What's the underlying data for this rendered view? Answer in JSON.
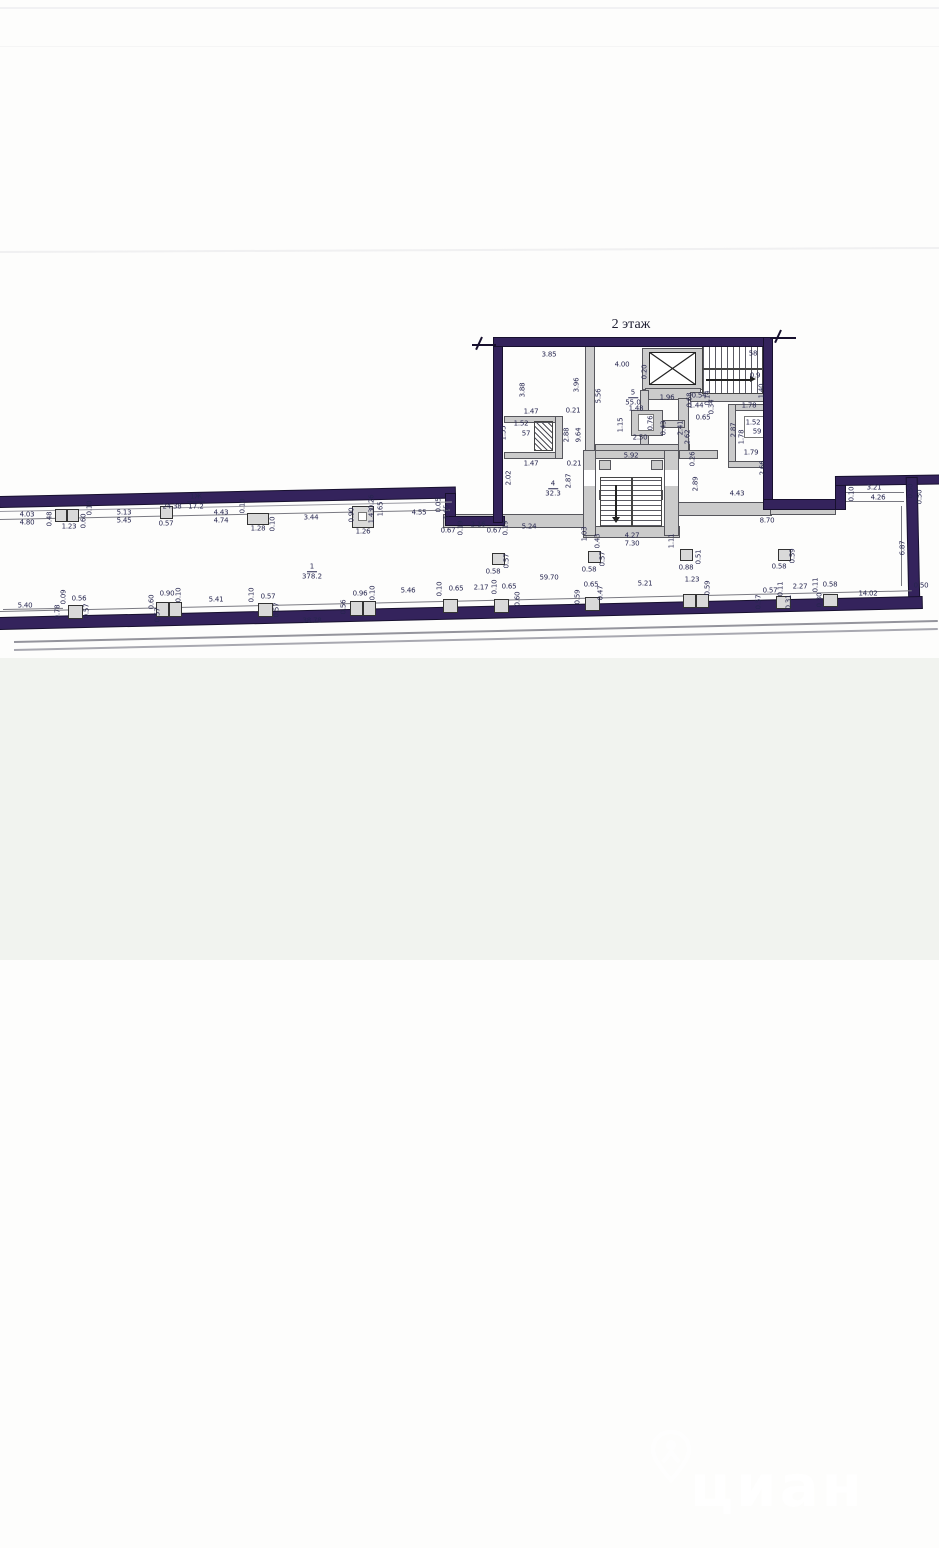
{
  "page": {
    "floor_title": "2 этаж"
  },
  "watermark": {
    "text": "циан"
  },
  "colors": {
    "wall": "#34235c",
    "dim_text": "#26264f",
    "paper": "#fdfdfc",
    "lower_bg": "#f1f3ef"
  },
  "plan": {
    "room_labels": [
      {
        "num": "1",
        "area": "378.2",
        "x": 312,
        "y": 571
      },
      {
        "num": "4",
        "area": "32.3",
        "x": 553,
        "y": 488
      },
      {
        "num": "5",
        "area": "55.0",
        "x": 633,
        "y": 397
      },
      {
        "num": "1Ж",
        "area": "17.2",
        "x": 196,
        "y": 501
      }
    ],
    "dimensions": [
      [
        "4.03",
        27,
        515,
        0
      ],
      [
        "4.80",
        27,
        523,
        0
      ],
      [
        "0.48",
        50,
        519,
        1
      ],
      [
        "1.23",
        69,
        527,
        0
      ],
      [
        "0.60",
        84,
        521,
        1
      ],
      [
        "0.10",
        90,
        508,
        1
      ],
      [
        "5.13",
        124,
        513,
        0
      ],
      [
        "5.45",
        124,
        521,
        0
      ],
      [
        "24.38",
        172,
        507,
        0
      ],
      [
        "0.57",
        166,
        524,
        0
      ],
      [
        "4.43",
        221,
        513,
        0
      ],
      [
        "4.74",
        221,
        521,
        0
      ],
      [
        "0.10",
        243,
        506,
        1
      ],
      [
        "1.28",
        258,
        529,
        0
      ],
      [
        "0.10",
        273,
        524,
        1
      ],
      [
        "3.44",
        311,
        518,
        0
      ],
      [
        "0.90",
        352,
        515,
        1
      ],
      [
        "0.26",
        372,
        502,
        1
      ],
      [
        "1.26",
        363,
        532,
        0
      ],
      [
        "1.43",
        372,
        516,
        1
      ],
      [
        "1.65",
        381,
        509,
        1
      ],
      [
        "4.55",
        419,
        513,
        0
      ],
      [
        "0.05",
        439,
        505,
        1
      ],
      [
        "1.65",
        447,
        512,
        1
      ],
      [
        "0.67",
        448,
        531,
        0
      ],
      [
        "0.19",
        461,
        528,
        1
      ],
      [
        "2.16",
        478,
        525,
        0
      ],
      [
        "0.67",
        494,
        531,
        0
      ],
      [
        "0.19",
        506,
        528,
        1
      ],
      [
        "5.24",
        529,
        527,
        0
      ],
      [
        "1.03",
        585,
        534,
        1
      ],
      [
        "0.43",
        598,
        541,
        1
      ],
      [
        "4.27",
        632,
        536,
        0
      ],
      [
        "7.30",
        632,
        544,
        0
      ],
      [
        "1.11",
        672,
        541,
        1
      ],
      [
        "8.70",
        767,
        521,
        0
      ],
      [
        "4.43",
        737,
        494,
        0
      ],
      [
        "3.85",
        549,
        355,
        0
      ],
      [
        "3.88",
        523,
        390,
        1
      ],
      [
        "3.96",
        577,
        385,
        1
      ],
      [
        "1.47",
        531,
        412,
        0
      ],
      [
        "0.21",
        573,
        411,
        0
      ],
      [
        "1.52",
        521,
        424,
        0
      ],
      [
        "57",
        526,
        434,
        0
      ],
      [
        "1.55",
        504,
        433,
        1
      ],
      [
        "2.88",
        567,
        435,
        1
      ],
      [
        "9.64",
        579,
        435,
        1
      ],
      [
        "1.47",
        531,
        464,
        0
      ],
      [
        "0.21",
        574,
        464,
        0
      ],
      [
        "2.02",
        509,
        478,
        1
      ],
      [
        "2.87",
        569,
        481,
        1
      ],
      [
        "5.56",
        599,
        396,
        1
      ],
      [
        "4.00",
        622,
        365,
        0
      ],
      [
        "0.20",
        645,
        372,
        1
      ],
      [
        "1.96",
        667,
        398,
        0
      ],
      [
        "1.48",
        636,
        409,
        0
      ],
      [
        "1.15",
        621,
        425,
        1
      ],
      [
        "0.76",
        651,
        423,
        1
      ],
      [
        "2.50",
        640,
        438,
        0
      ],
      [
        "0.43",
        664,
        428,
        1
      ],
      [
        "5.92",
        631,
        456,
        0
      ],
      [
        "2.41",
        681,
        428,
        1
      ],
      [
        "2.62",
        688,
        437,
        1
      ],
      [
        "0.68",
        690,
        400,
        1
      ],
      [
        "0.54",
        699,
        396,
        0
      ],
      [
        "0.14",
        708,
        398,
        1
      ],
      [
        "58",
        753,
        354,
        0
      ],
      [
        "0.9",
        755,
        376,
        0
      ],
      [
        "1.40",
        762,
        391,
        1
      ],
      [
        "1.44",
        696,
        406,
        0
      ],
      [
        "0.34",
        712,
        407,
        1
      ],
      [
        "0.65",
        703,
        418,
        0
      ],
      [
        "1.78",
        749,
        406,
        0
      ],
      [
        "2.87",
        734,
        430,
        1
      ],
      [
        "1.52",
        753,
        423,
        0
      ],
      [
        "59",
        757,
        432,
        0
      ],
      [
        "1.78",
        742,
        437,
        1
      ],
      [
        "1.79",
        751,
        453,
        0
      ],
      [
        "2.66",
        763,
        468,
        1
      ],
      [
        "0.26",
        693,
        459,
        1
      ],
      [
        "2.89",
        696,
        484,
        1
      ],
      [
        "0.58",
        493,
        572,
        0
      ],
      [
        "0.57",
        507,
        561,
        1
      ],
      [
        "0.58",
        589,
        570,
        0
      ],
      [
        "0.57",
        603,
        559,
        1
      ],
      [
        "0.88",
        686,
        568,
        0
      ],
      [
        "0.51",
        699,
        557,
        1
      ],
      [
        "0.58",
        779,
        567,
        0
      ],
      [
        "0.59",
        793,
        556,
        1
      ],
      [
        "59.70",
        549,
        578,
        0
      ],
      [
        "3.21",
        874,
        488,
        0
      ],
      [
        "4.26",
        878,
        498,
        0
      ],
      [
        "0.10",
        852,
        494,
        1
      ],
      [
        "0.50",
        911,
        491,
        1
      ],
      [
        "0.50",
        920,
        497,
        1
      ],
      [
        "6.87",
        903,
        548,
        1
      ],
      [
        "0.50",
        921,
        586,
        0
      ],
      [
        "5.40",
        25,
        606,
        0
      ],
      [
        "0.09",
        64,
        597,
        1
      ],
      [
        "0.56",
        79,
        599,
        0
      ],
      [
        "0.78",
        58,
        612,
        1
      ],
      [
        "0.57",
        87,
        611,
        1
      ],
      [
        "0.60",
        152,
        602,
        1
      ],
      [
        "0.90",
        167,
        594,
        0
      ],
      [
        "0.10",
        179,
        595,
        1
      ],
      [
        "0.57",
        158,
        615,
        1
      ],
      [
        "5.41",
        216,
        600,
        0
      ],
      [
        "0.10",
        252,
        595,
        1
      ],
      [
        "0.57",
        268,
        597,
        0
      ],
      [
        "0.57",
        277,
        610,
        1
      ],
      [
        "38.78",
        312,
        621,
        0
      ],
      [
        "0.56",
        344,
        607,
        1
      ],
      [
        "0.96",
        360,
        594,
        0
      ],
      [
        "0.10",
        373,
        593,
        1
      ],
      [
        "5.46",
        408,
        591,
        0
      ],
      [
        "0.10",
        440,
        589,
        1
      ],
      [
        "0.65",
        456,
        589,
        0
      ],
      [
        "2.17",
        481,
        588,
        0
      ],
      [
        "0.10",
        495,
        587,
        1
      ],
      [
        "0.65",
        509,
        587,
        0
      ],
      [
        "0.60",
        518,
        599,
        1
      ],
      [
        "0.59",
        578,
        597,
        1
      ],
      [
        "0.65",
        591,
        585,
        0
      ],
      [
        "0.47",
        601,
        593,
        1
      ],
      [
        "5.21",
        645,
        584,
        0
      ],
      [
        "1.23",
        692,
        580,
        0
      ],
      [
        "0.59",
        708,
        588,
        1
      ],
      [
        "0.57",
        759,
        602,
        1
      ],
      [
        "0.57",
        770,
        591,
        0
      ],
      [
        "0.11",
        781,
        589,
        1
      ],
      [
        "2.27",
        800,
        587,
        0
      ],
      [
        "0.11",
        816,
        585,
        1
      ],
      [
        "0.58",
        830,
        585,
        0
      ],
      [
        "0.31",
        789,
        602,
        1
      ],
      [
        "0.30",
        820,
        600,
        1
      ],
      [
        "14.02",
        868,
        594,
        0
      ]
    ]
  }
}
